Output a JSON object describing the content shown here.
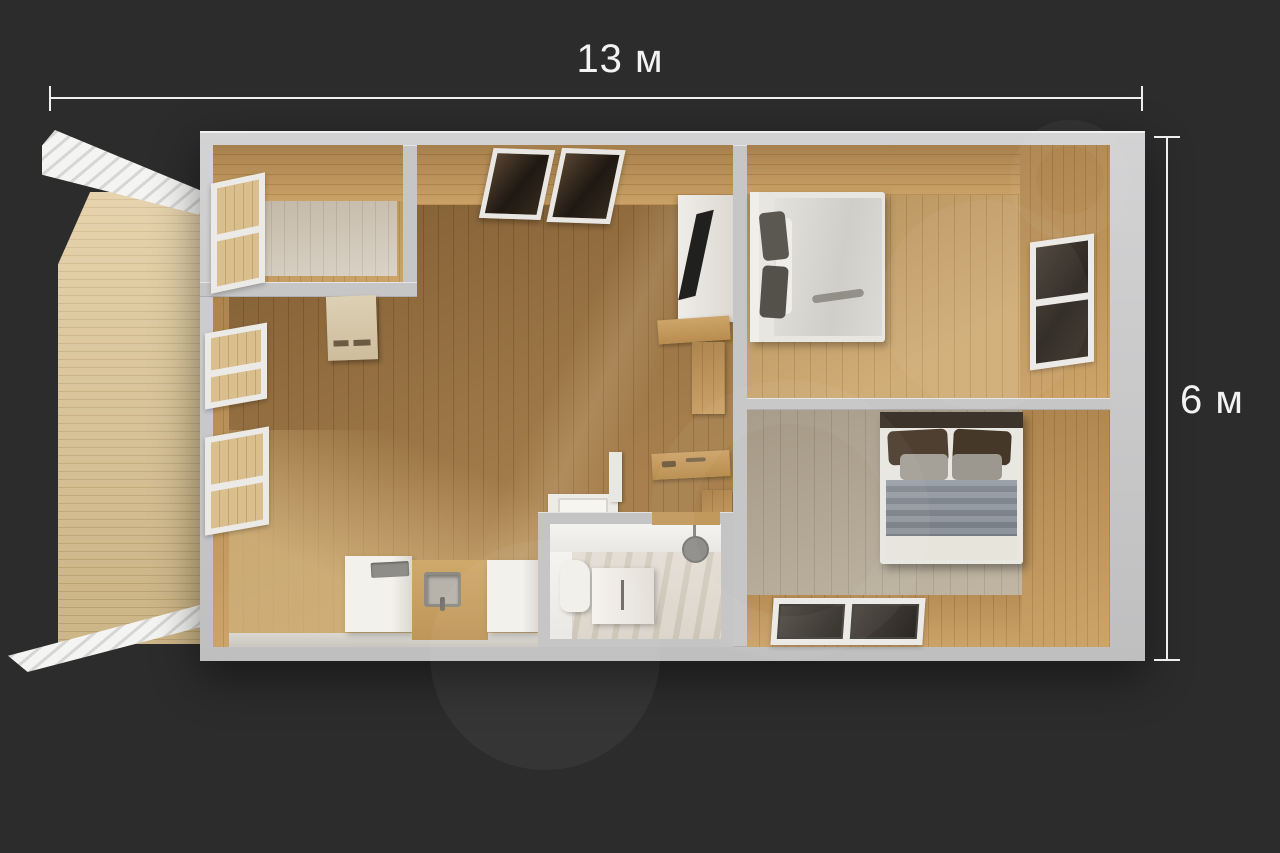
{
  "page": {
    "type": "3d-floor-plan-render"
  },
  "dimension_labels": {
    "width": "13 м",
    "height": "6 м"
  },
  "colors": {
    "background": "#2d2c2c",
    "dimension": "#f3f3f3",
    "wall_gray": "#c6c6c7",
    "wood_wall": "#c49a5f",
    "living_floor": "#9d7543",
    "entry_floor": "#d2c9ba",
    "bedroom_top_floor": "#c6a068",
    "bedroom_bottom_floor": "#b6aa96",
    "terrace_deck": "#dec593",
    "pergola_white": "#f4f4f2",
    "bathroom_floor": "#d8d1c6",
    "fixture_white": "#f3f1ec",
    "glass_dark": "#2c2721"
  }
}
